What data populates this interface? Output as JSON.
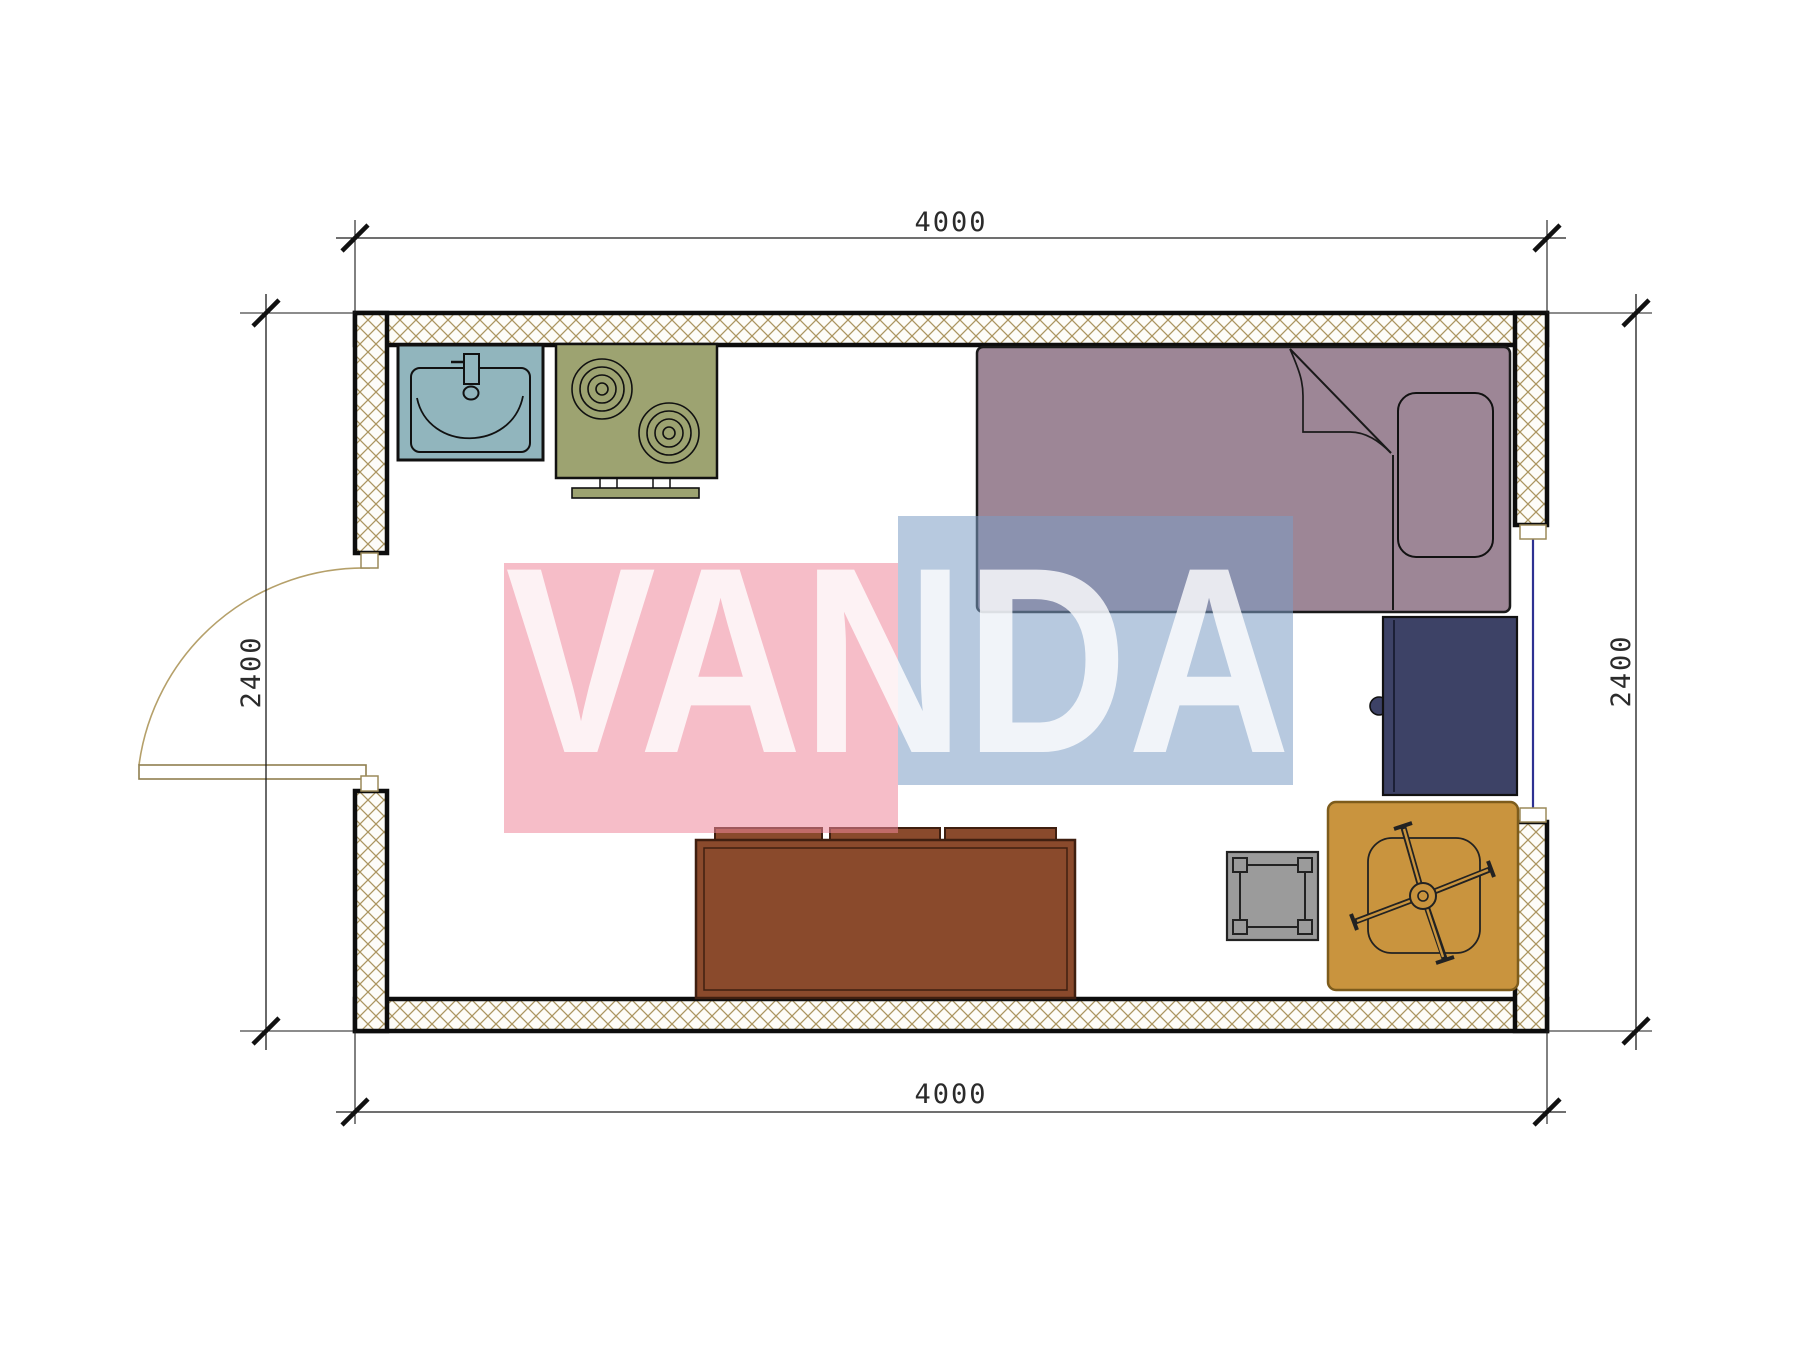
{
  "plan": {
    "type": "studio floor plan",
    "dimensions": {
      "top": "4000",
      "bottom": "4000",
      "left": "2400",
      "right": "2400"
    }
  },
  "watermark": {
    "text": "VANDA",
    "pink_color": "#ee879b",
    "blue_color": "#7c9dc5",
    "letter_color": "#ffffff"
  },
  "colors": {
    "sink": "#91b5bd",
    "stove": "#9da371",
    "stove_handle": "#9da371",
    "bed": "#9d8696",
    "pillow": "#9d8696",
    "desk": "#3d4266",
    "desk_knob": "#3d4266",
    "sofa": "#8a4a2c",
    "sofa_outline": "#3f1f10",
    "stool": "#9b9b9b",
    "chair_mat": "#c9943e",
    "chair_mat_border": "#7d5c1c",
    "wall_hatch": "#ab9560",
    "wall_fill": "#fdfcf8",
    "window": "#2e3192",
    "door": "#b5a06a"
  }
}
